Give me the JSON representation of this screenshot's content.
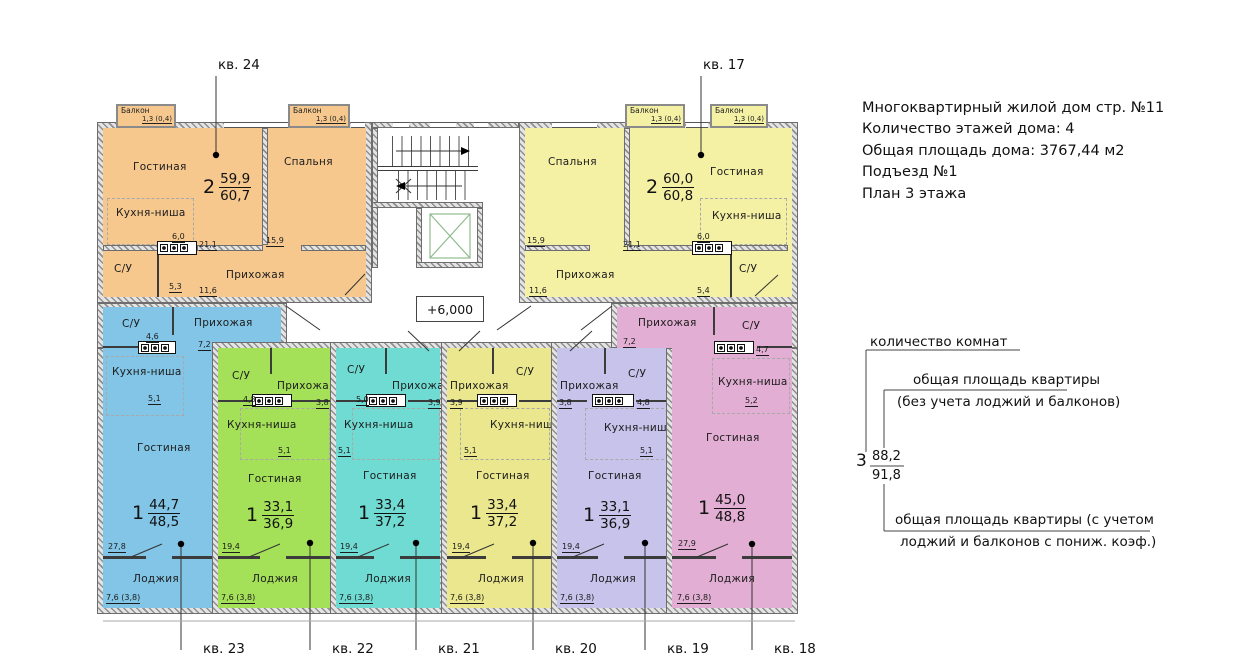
{
  "title_block": {
    "line1": "Многоквартирный жилой дом стр. №11",
    "line2": "Количество этажей дома: 4",
    "line3": "Общая площадь дома: 3767,44 м2",
    "line4": "Подъезд №1",
    "line5": "План 3 этажа"
  },
  "legend": {
    "rooms_count_label": "количество комнат",
    "area_excl_line1": "общая площадь квартиры",
    "area_excl_line2": "(без учета лоджий и балконов)",
    "example_rooms": "3",
    "example_area": "88,2",
    "example_area_total": "91,8",
    "area_incl_line1": "общая площадь квартиры  (с учетом",
    "area_incl_line2": "лоджий и балконов с пониж. коэф.)"
  },
  "plan": {
    "elevation": "+6,000",
    "balcony_label": "Балкон",
    "balcony_area": "1,3 (0,4)",
    "apartments": [
      {
        "callout": "кв. 24",
        "rooms_count": "2",
        "area": "59,9",
        "area_total": "60,7",
        "living": "Гостиная",
        "living_area": "21,1",
        "bedroom": "Спальня",
        "bedroom_area": "15,9",
        "kitchen": "Кухня-ниша",
        "kitchen_area": "6,0",
        "bath": "С/У",
        "bath_area": "5,3",
        "hall": "Прихожая",
        "hall_area": "11,6"
      },
      {
        "callout": "кв. 17",
        "rooms_count": "2",
        "area": "60,0",
        "area_total": "60,8",
        "living": "Гостиная",
        "living_area": "21,1",
        "bedroom": "Спальня",
        "bedroom_area": "15,9",
        "kitchen": "Кухня-ниша",
        "kitchen_area": "6,0",
        "bath": "С/У",
        "bath_area": "5,4",
        "hall": "Прихожая",
        "hall_area": "11,6"
      },
      {
        "callout": "кв. 23",
        "rooms_count": "1",
        "area": "44,7",
        "area_total": "48,5",
        "bath": "С/У",
        "bath_area": "4,6",
        "hall": "Прихожая",
        "hall_area": "7,2",
        "kitchen": "Кухня-ниша",
        "kitchen_area": "5,1",
        "living": "Гостиная",
        "living_area": "27,8",
        "loggia": "Лоджия",
        "loggia_area": "7,6 (3,8)"
      },
      {
        "callout": "кв. 22",
        "rooms_count": "1",
        "area": "33,1",
        "area_total": "36,9",
        "bath": "С/У",
        "bath_area": "4,8",
        "hall": "Прихожая",
        "hall_area": "3,8",
        "kitchen": "Кухня-ниша",
        "kitchen_area": "5,1",
        "living": "Гостиная",
        "living_area": "19,4",
        "loggia": "Лоджия",
        "loggia_area": "7,6 (3,8)"
      },
      {
        "callout": "кв. 21",
        "rooms_count": "1",
        "area": "33,4",
        "area_total": "37,2",
        "bath": "С/У",
        "bath_area": "5,0",
        "hall": "Прихожая",
        "hall_area": "3,9",
        "kitchen": "Кухня-ниша",
        "kitchen_area": "5,1",
        "living": "Гостиная",
        "living_area": "19,4",
        "loggia": "Лоджия",
        "loggia_area": "7,6 (3,8)"
      },
      {
        "callout": "кв. 20",
        "rooms_count": "1",
        "area": "33,4",
        "area_total": "37,2",
        "bath": "С/У",
        "hall": "Прихожая",
        "hall_area": "3,9",
        "kitchen": "Кухня-ниша",
        "kitchen_area": "5,1",
        "living": "Гостиная",
        "living_area": "19,4",
        "loggia": "Лоджия",
        "loggia_area": "7,6 (3,8)"
      },
      {
        "callout": "кв. 19",
        "rooms_count": "1",
        "area": "33,1",
        "area_total": "36,9",
        "bath": "С/У",
        "bath_area": "4,8",
        "hall": "Прихожая",
        "hall_area": "3,8",
        "kitchen": "Кухня-ниша",
        "kitchen_area": "5,1",
        "living": "Гостиная",
        "living_area": "19,4",
        "loggia": "Лоджия",
        "loggia_area": "7,6 (3,8)"
      },
      {
        "callout": "кв. 18",
        "rooms_count": "1",
        "area": "45,0",
        "area_total": "48,8",
        "bath": "С/У",
        "bath_area": "4,7",
        "hall": "Прихожая",
        "hall_area": "7,2",
        "kitchen": "Кухня-ниша",
        "kitchen_area": "5,2",
        "living": "Гостиная",
        "living_area": "27,9",
        "loggia": "Лоджия",
        "loggia_area": "7,6 (3,8)"
      }
    ]
  },
  "colors": {
    "kv24": "#f6c88e",
    "kv17": "#f4f0a4",
    "kv23": "#82c5e6",
    "kv22": "#a4e058",
    "kv21": "#70dbd3",
    "kv20": "#eae78e",
    "kv19": "#c7c3eb",
    "kv18": "#e2aed3",
    "elevator_accent": "#8fbc8f"
  }
}
